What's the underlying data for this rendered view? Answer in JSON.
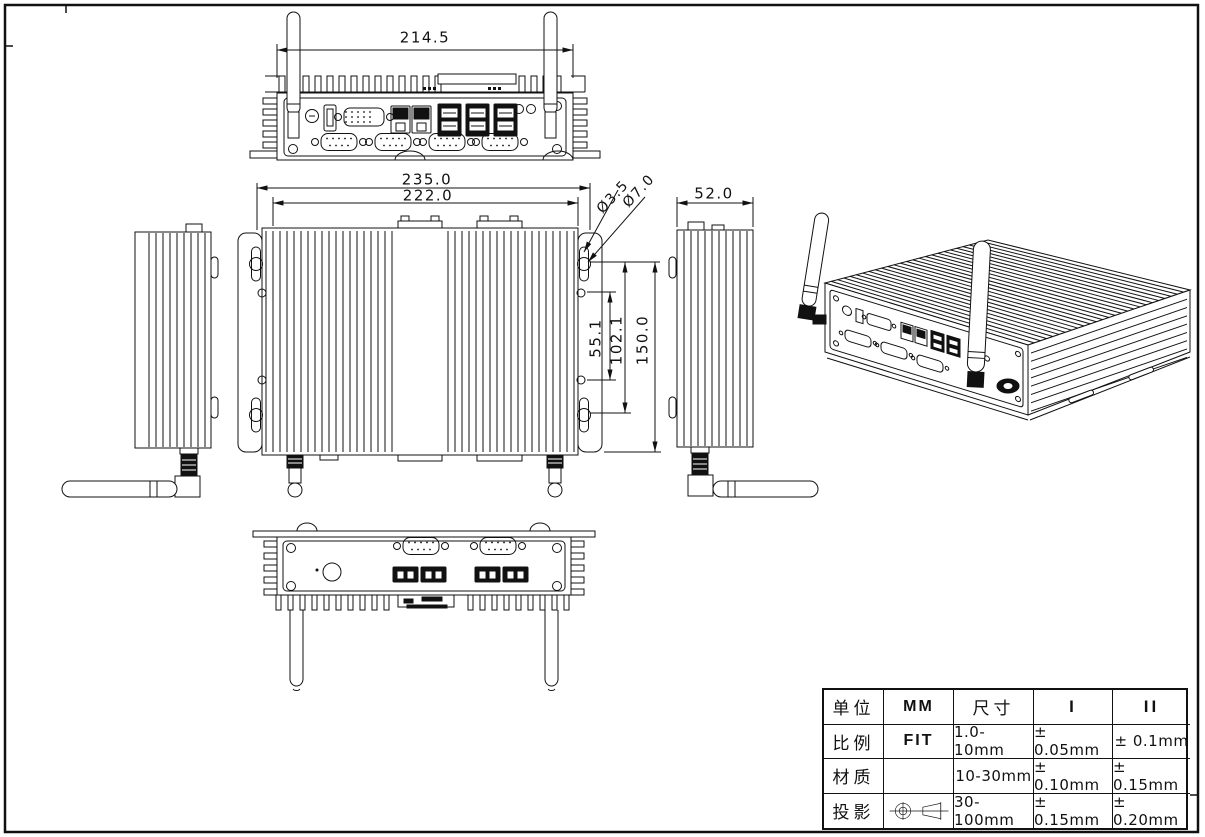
{
  "colors": {
    "line": "#111111",
    "background": "#ffffff"
  },
  "dims": {
    "rear_width": "214.5",
    "overall_width": "235.0",
    "fin_width": "222.0",
    "hole_small": "Ø3.5",
    "hole_large": "Ø7.0",
    "side_depth": "52.0",
    "hole_pitch_inner": "55.1",
    "hole_pitch_outer": "102.1",
    "overall_depth": "150.0"
  },
  "table": {
    "rows": [
      [
        "单位",
        "MM",
        "尺寸",
        "I",
        "II"
      ],
      [
        "比例",
        "FIT",
        "1.0-10mm",
        "± 0.05mm",
        "± 0.1mm"
      ],
      [
        "材质",
        "",
        "10-30mm",
        "± 0.10mm",
        "± 0.15mm"
      ],
      [
        "投影",
        "",
        "30-100mm",
        "± 0.15mm",
        "± 0.20mm"
      ]
    ]
  },
  "icons": {
    "projection_symbol": "first-angle-projection-icon"
  }
}
